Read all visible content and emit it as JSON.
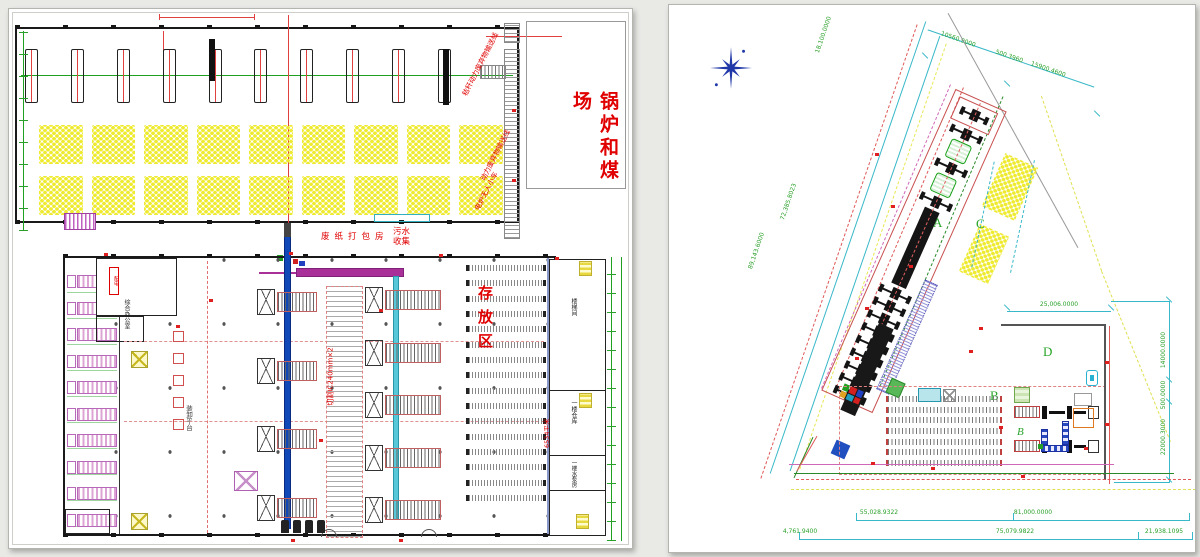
{
  "colors": {
    "cad_red": "#e00000",
    "dim_green": "#2aa02a",
    "cad_cyan": "#38b8c8",
    "cad_yellow": "#f0ee30",
    "cad_blue": "#1048b8",
    "cad_magenta": "#a83098",
    "wall_dark": "#1a1a1a"
  },
  "left_sheet": {
    "title_vertical": "锅炉和煤场",
    "labels": {
      "conveyor_line_top": "秸秆动力废弃物输送线",
      "conveyor_line_side": "动力废弃物输送线",
      "electric_cart": "电炉无人小车",
      "packing_room": "废纸打包房",
      "sewage_collection": "污水收集",
      "storage_zone": "存放区",
      "cutter_spec": "切割IC240mm×2",
      "office": "综合办公室",
      "power_room": "配电",
      "dock_platform": "装卸平台",
      "area_note": "6534平米",
      "room_stairwell": "楼梯间",
      "room_warehouse": "一楼仓库",
      "room_pump": "一楼水泵房"
    }
  },
  "right_sheet": {
    "zone_labels": {
      "a": "A",
      "b": "B",
      "b_italic": "B",
      "c": "C",
      "d": "D"
    },
    "dimensions": {
      "site_left_outer": "89,143.6000",
      "site_left_inner": "72,385.8023",
      "site_top": "18,100.0000",
      "top_right_1": "10560.9000",
      "top_right_2": "500.3960",
      "top_right_3": "15900.4600",
      "yard_top": "25,006.0000",
      "right_1": "14000.0000",
      "right_2": "500.0000",
      "right_3": "22000.3000",
      "bottom_row1_left": "55,028.9322",
      "bottom_row1_right": "81,000.0000",
      "bottom_row2_left": "4,761.9400",
      "bottom_row2_mid": "75,079.9822",
      "bottom_row2_right": "21,938.1095"
    }
  }
}
